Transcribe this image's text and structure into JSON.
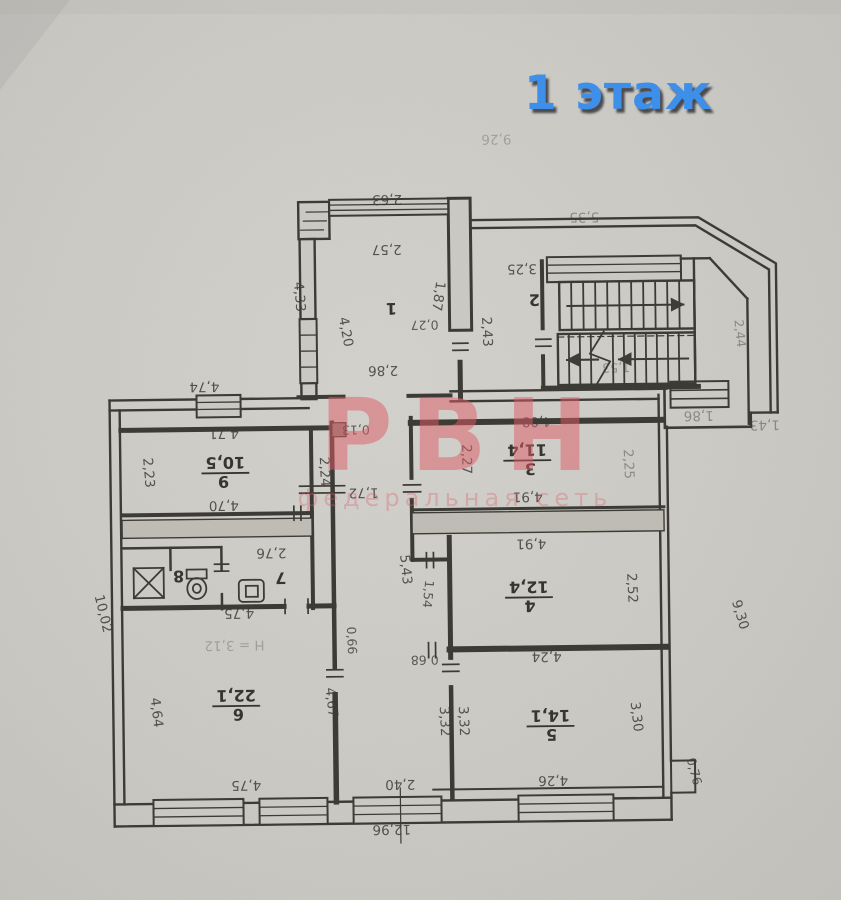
{
  "page": {
    "floor_title": "1 этаж",
    "title_color": "#3e8fe9"
  },
  "watermark": {
    "logo": "РВН",
    "subtitle": "федеральная сеть",
    "color": "#df5a64"
  },
  "plan": {
    "rooms": {
      "r1": {
        "number": "1"
      },
      "r2": {
        "number": "2"
      },
      "r3": {
        "number": "3",
        "area": "11,4"
      },
      "r4": {
        "number": "4",
        "area": "12,4"
      },
      "r5": {
        "number": "5",
        "area": "14,1"
      },
      "r6": {
        "number": "6",
        "area": "22,1"
      },
      "r7": {
        "number": "7"
      },
      "r8": {
        "number": "8"
      },
      "r9": {
        "number": "9",
        "area": "10,5"
      }
    },
    "dims": {
      "d2_63": "2,63",
      "d2_57": "2,57",
      "d1_87": "1,87",
      "d4_33": "4,33",
      "d4_20": "4,20",
      "d2_86": "2,86",
      "d0_27": "0,27",
      "d2_43": "2,43",
      "d3_25": "3,25",
      "d5_35": "5,35",
      "d1_53": "1,53",
      "d2_44": "2,44",
      "d1_86": "1,86",
      "d1_43": "1,43",
      "d4_74": "4,74",
      "d4_71": "4,71",
      "d2_23": "2,23",
      "d2_24": "2,24",
      "d0_13": "0,13",
      "d4_70": "4,70",
      "d1_72": "1,72",
      "d2_76": "2,76",
      "d4_75a": "4,75",
      "d4_75b": "4,75",
      "d4_64": "4,64",
      "d4_67": "4,67",
      "d0_66": "0,66",
      "d4_08": "4,08",
      "d2_27": "2,27",
      "d2_25": "2,25",
      "d4_91a": "4,91",
      "d4_91b": "4,91",
      "d2_52": "2,52",
      "d5_43": "5,43",
      "d1_54": "1,54",
      "d0_68": "0,68",
      "d4_24": "4,24",
      "d3_32a": "3,32",
      "d3_32b": "3,32",
      "d3_30": "3,30",
      "d0_76": "0,76",
      "d4_26": "4,26",
      "d2_40": "2,40",
      "d12_96": "12,96",
      "d10_02": "10,02",
      "d9_30": "9,30"
    },
    "notes": {
      "ceiling_height": "Н = 3,12",
      "faint_top": "9,26"
    }
  }
}
